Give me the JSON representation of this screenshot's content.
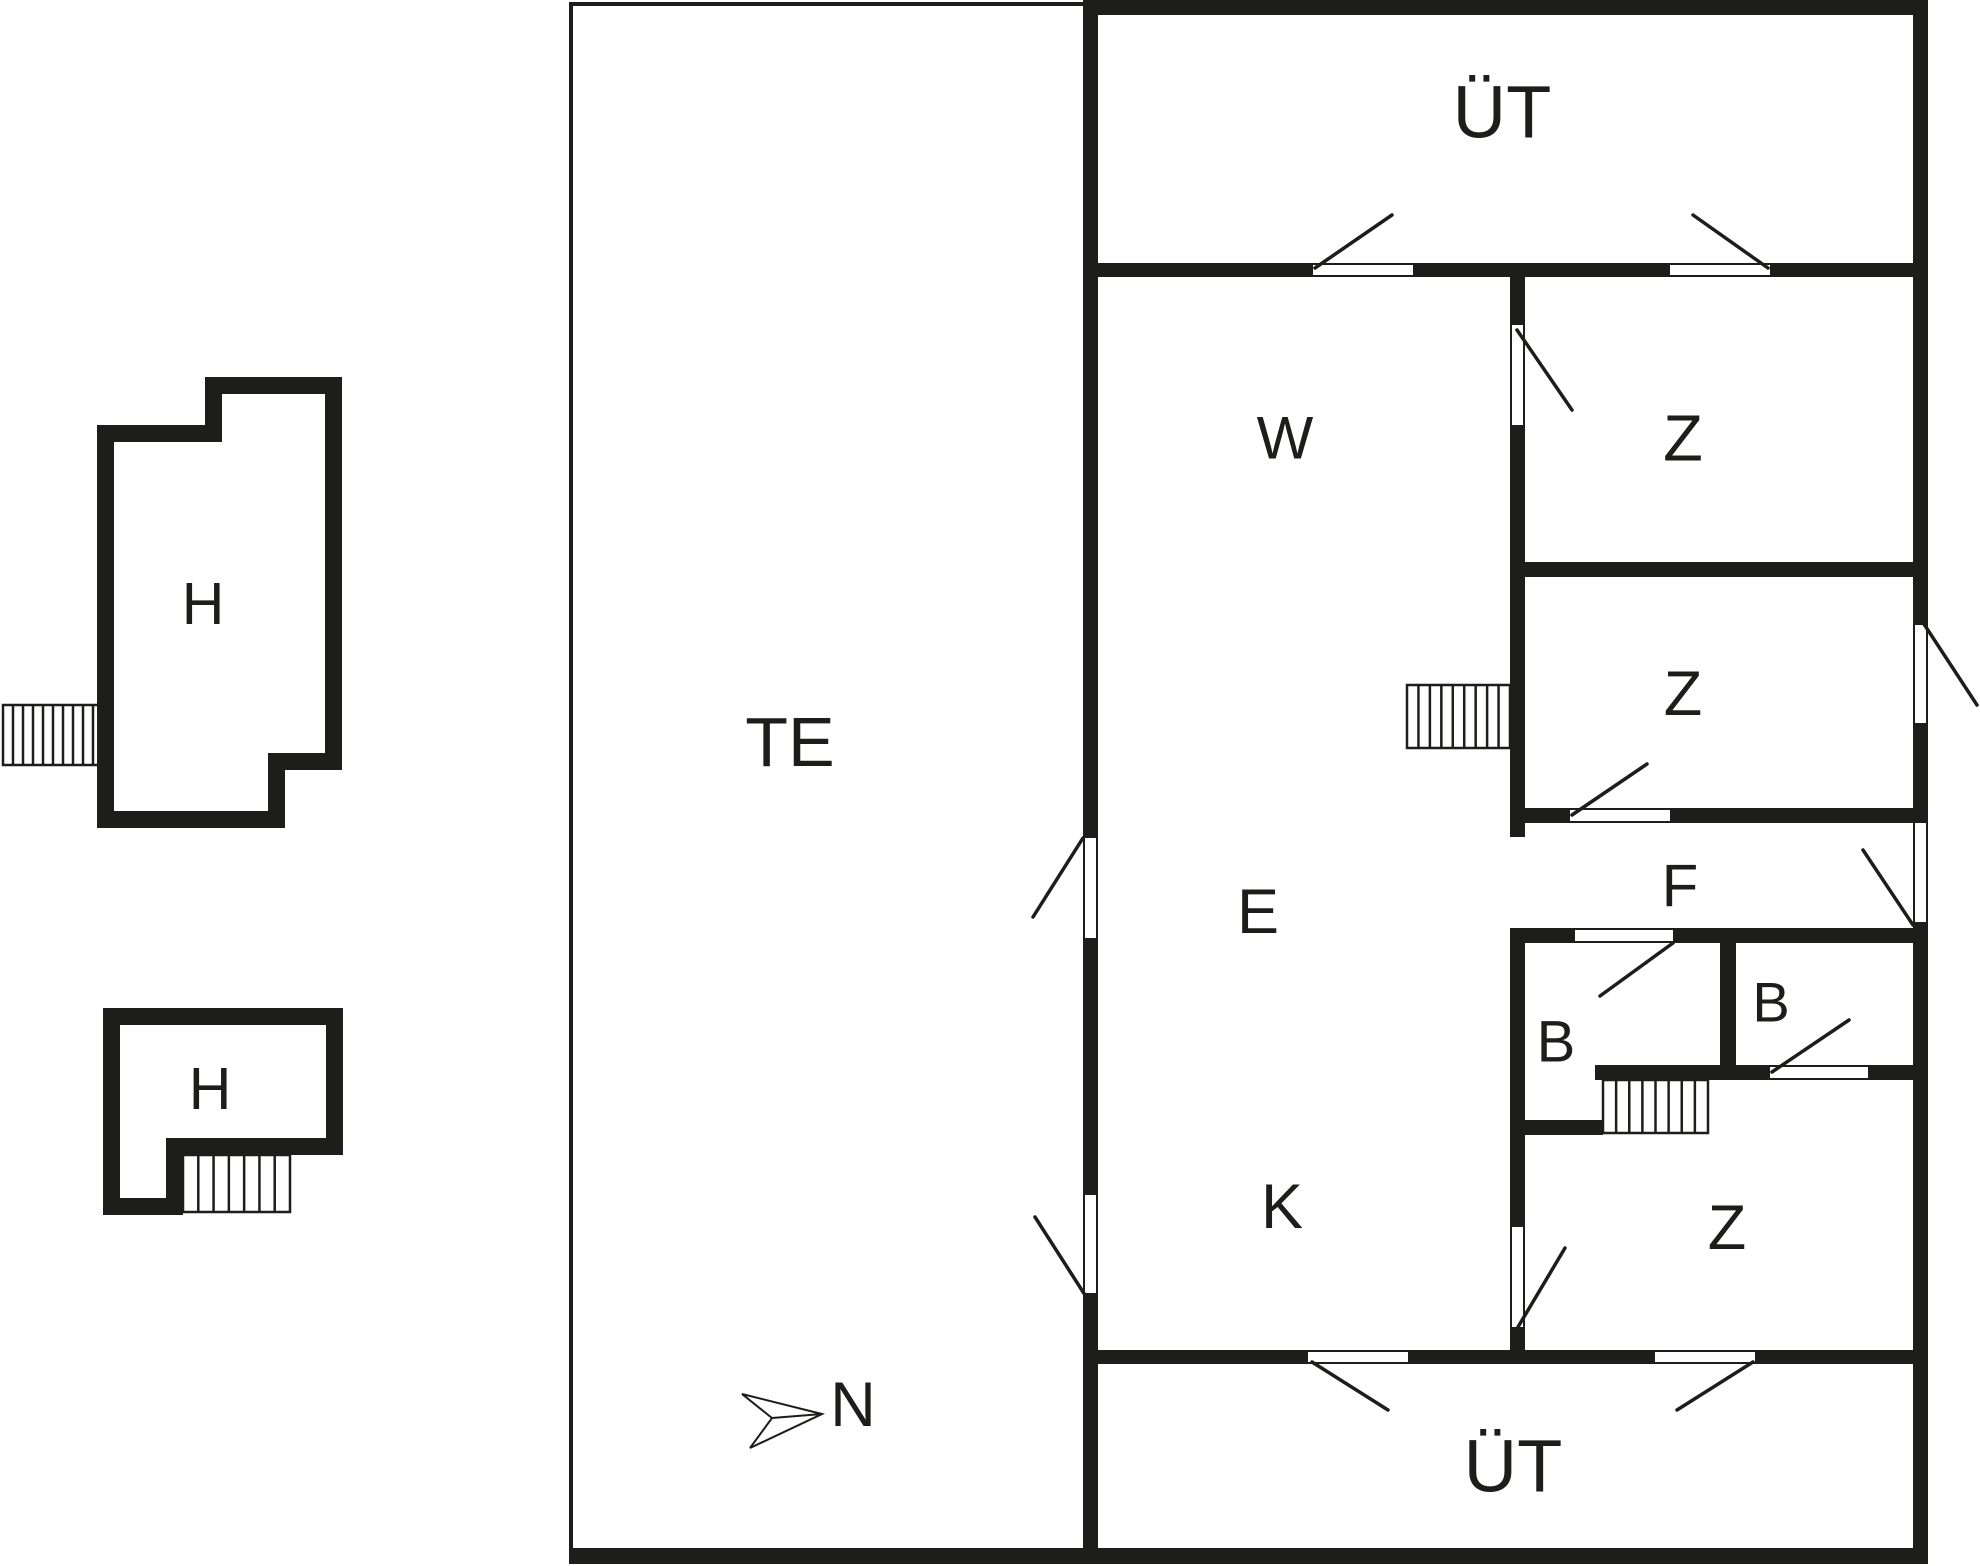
{
  "plan": {
    "ink": "#1d1d1b",
    "bg": "#ffffff",
    "walls": [
      {
        "name": "building-wall-left",
        "x": 1083,
        "y": 0,
        "w": 15,
        "h": 1563
      },
      {
        "name": "building-wall-top",
        "x": 1083,
        "y": 0,
        "w": 845,
        "h": 15
      },
      {
        "name": "building-wall-right",
        "x": 1913,
        "y": 0,
        "w": 15,
        "h": 1563
      },
      {
        "name": "building-wall-bottom",
        "x": 569,
        "y": 1548,
        "w": 1359,
        "h": 16
      },
      {
        "name": "wall-ut-top-bottom",
        "x": 1098,
        "y": 263,
        "w": 830,
        "h": 14
      },
      {
        "name": "wall-main-divider",
        "x": 1510,
        "y": 277,
        "w": 15,
        "h": 1087
      },
      {
        "name": "wall-z1-z2",
        "x": 1510,
        "y": 562,
        "w": 418,
        "h": 15
      },
      {
        "name": "wall-z2-bottom",
        "x": 1510,
        "y": 808,
        "w": 418,
        "h": 15
      },
      {
        "name": "wall-b-top",
        "x": 1510,
        "y": 928,
        "w": 418,
        "h": 15
      },
      {
        "name": "wall-b-divider",
        "x": 1720,
        "y": 943,
        "w": 16,
        "h": 122
      },
      {
        "name": "wall-b-bottom",
        "x": 1595,
        "y": 1065,
        "w": 318,
        "h": 15
      },
      {
        "name": "wall-b-left-bottom",
        "x": 1510,
        "y": 1120,
        "w": 93,
        "h": 15
      },
      {
        "name": "wall-ut-bottom-top",
        "x": 1098,
        "y": 1350,
        "w": 830,
        "h": 14
      }
    ],
    "thin": [
      {
        "name": "terrace-edge-top",
        "x": 569,
        "y": 2,
        "w": 514,
        "h": 4
      },
      {
        "name": "terrace-edge-left",
        "x": 569,
        "y": 2,
        "w": 4,
        "h": 1554
      }
    ],
    "openings": [
      {
        "name": "door-opening-w-to-terrace",
        "x": 1083,
        "y": 838,
        "w": 15,
        "h": 100,
        "dir": "v"
      },
      {
        "name": "door-opening-k-to-terrace",
        "x": 1083,
        "y": 1195,
        "w": 15,
        "h": 98,
        "dir": "v"
      },
      {
        "name": "door-opening-z2-exterior",
        "x": 1913,
        "y": 625,
        "w": 15,
        "h": 98,
        "dir": "v"
      },
      {
        "name": "door-opening-f-exterior",
        "x": 1913,
        "y": 823,
        "w": 15,
        "h": 99,
        "dir": "v"
      },
      {
        "name": "door-opening-ut-top-left",
        "x": 1313,
        "y": 263,
        "w": 100,
        "h": 14,
        "dir": "h"
      },
      {
        "name": "door-opening-ut-top-right",
        "x": 1670,
        "y": 263,
        "w": 100,
        "h": 14,
        "dir": "h"
      },
      {
        "name": "door-opening-w-to-z1",
        "x": 1510,
        "y": 325,
        "w": 15,
        "h": 100,
        "dir": "v"
      },
      {
        "name": "passage-e-to-f",
        "x": 1510,
        "y": 837,
        "w": 15,
        "h": 91,
        "dir": "v",
        "frame": false
      },
      {
        "name": "door-opening-k-to-z3",
        "x": 1510,
        "y": 1227,
        "w": 15,
        "h": 100,
        "dir": "v"
      },
      {
        "name": "door-opening-f-to-z2",
        "x": 1570,
        "y": 808,
        "w": 100,
        "h": 15,
        "dir": "h"
      },
      {
        "name": "door-opening-f-to-b-left",
        "x": 1575,
        "y": 928,
        "w": 98,
        "h": 15,
        "dir": "h"
      },
      {
        "name": "door-opening-z3-to-b-right",
        "x": 1770,
        "y": 1065,
        "w": 98,
        "h": 15,
        "dir": "h"
      },
      {
        "name": "door-opening-ut-bottom-left",
        "x": 1308,
        "y": 1350,
        "w": 100,
        "h": 14,
        "dir": "h"
      },
      {
        "name": "door-opening-ut-bottom-right",
        "x": 1655,
        "y": 1350,
        "w": 100,
        "h": 14,
        "dir": "h"
      }
    ],
    "swings": [
      {
        "name": "door-swing-w-to-terrace",
        "x1": 1083,
        "y1": 838,
        "x2": 1033,
        "y2": 917
      },
      {
        "name": "door-swing-k-to-terrace",
        "x1": 1085,
        "y1": 1295,
        "x2": 1035,
        "y2": 1217
      },
      {
        "name": "door-swing-z2-exterior",
        "x1": 1920,
        "y1": 618,
        "x2": 1977,
        "y2": 705
      },
      {
        "name": "door-swing-f-exterior",
        "x1": 1913,
        "y1": 925,
        "x2": 1863,
        "y2": 850
      },
      {
        "name": "door-swing-ut-top-left",
        "x1": 1315,
        "y1": 268,
        "x2": 1392,
        "y2": 215
      },
      {
        "name": "door-swing-ut-top-right",
        "x1": 1768,
        "y1": 268,
        "x2": 1693,
        "y2": 215
      },
      {
        "name": "door-swing-w-to-z1",
        "x1": 1517,
        "y1": 330,
        "x2": 1572,
        "y2": 410
      },
      {
        "name": "door-swing-k-to-z3",
        "x1": 1518,
        "y1": 1327,
        "x2": 1565,
        "y2": 1248
      },
      {
        "name": "door-swing-f-to-z2",
        "x1": 1572,
        "y1": 815,
        "x2": 1647,
        "y2": 764
      },
      {
        "name": "door-swing-f-to-b-left",
        "x1": 1673,
        "y1": 943,
        "x2": 1600,
        "y2": 996
      },
      {
        "name": "door-swing-z3-to-b-right",
        "x1": 1772,
        "y1": 1072,
        "x2": 1849,
        "y2": 1020
      },
      {
        "name": "door-swing-ut-bottom-left",
        "x1": 1312,
        "y1": 1362,
        "x2": 1388,
        "y2": 1410
      },
      {
        "name": "door-swing-ut-bottom-right",
        "x1": 1753,
        "y1": 1362,
        "x2": 1677,
        "y2": 1410
      }
    ],
    "stairs": [
      {
        "name": "stairs-outbuilding-1",
        "x": 3,
        "y": 705,
        "w": 100,
        "h": 60,
        "steps": 10
      },
      {
        "name": "stairs-z2-entry",
        "x": 1407,
        "y": 685,
        "w": 103,
        "h": 63,
        "steps": 9
      },
      {
        "name": "stairs-interior",
        "x": 1603,
        "y": 1080,
        "w": 105,
        "h": 53,
        "steps": 8
      },
      {
        "name": "stairs-outbuilding-2",
        "x": 183,
        "y": 1155,
        "w": 107,
        "h": 57,
        "steps": 7
      }
    ],
    "buildings": [
      {
        "name": "outbuilding-h1",
        "outer": [
          [
            97,
            425
          ],
          [
            205,
            425
          ],
          [
            205,
            377
          ],
          [
            342,
            377
          ],
          [
            342,
            770
          ],
          [
            285,
            770
          ],
          [
            285,
            828
          ],
          [
            97,
            828
          ]
        ],
        "inner": [
          [
            114,
            442
          ],
          [
            222,
            442
          ],
          [
            222,
            394
          ],
          [
            325,
            394
          ],
          [
            325,
            753
          ],
          [
            268,
            753
          ],
          [
            268,
            811
          ],
          [
            114,
            811
          ]
        ]
      },
      {
        "name": "outbuilding-h2",
        "outer": [
          [
            103,
            1008
          ],
          [
            343,
            1008
          ],
          [
            343,
            1155
          ],
          [
            183,
            1155
          ],
          [
            183,
            1215
          ],
          [
            103,
            1215
          ]
        ],
        "inner": [
          [
            120,
            1025
          ],
          [
            326,
            1025
          ],
          [
            326,
            1138
          ],
          [
            166,
            1138
          ],
          [
            166,
            1198
          ],
          [
            120,
            1198
          ]
        ]
      }
    ],
    "compass": {
      "label": "N",
      "x": 853,
      "y": 1405,
      "size": 63,
      "arrow": [
        [
          822,
          1414
        ],
        [
          742,
          1394
        ],
        [
          772,
          1418
        ],
        [
          750,
          1448
        ]
      ]
    },
    "labels": [
      {
        "name": "room-label-terrace",
        "text": "TE",
        "x": 790,
        "y": 742,
        "size": 70
      },
      {
        "name": "room-label-ut-top",
        "text": "ÜT",
        "x": 1502,
        "y": 112,
        "size": 74
      },
      {
        "name": "room-label-w",
        "text": "W",
        "x": 1285,
        "y": 438,
        "size": 60
      },
      {
        "name": "room-label-z-upper",
        "text": "Z",
        "x": 1683,
        "y": 438,
        "size": 65
      },
      {
        "name": "room-label-z-middle",
        "text": "Z",
        "x": 1683,
        "y": 694,
        "size": 63
      },
      {
        "name": "room-label-e",
        "text": "E",
        "x": 1258,
        "y": 912,
        "size": 63
      },
      {
        "name": "room-label-f",
        "text": "F",
        "x": 1680,
        "y": 886,
        "size": 60
      },
      {
        "name": "room-label-b-left",
        "text": "B",
        "x": 1556,
        "y": 1042,
        "size": 58
      },
      {
        "name": "room-label-b-right",
        "text": "B",
        "x": 1771,
        "y": 1002,
        "size": 56
      },
      {
        "name": "room-label-k",
        "text": "K",
        "x": 1282,
        "y": 1207,
        "size": 63
      },
      {
        "name": "room-label-z-bottom",
        "text": "Z",
        "x": 1727,
        "y": 1228,
        "size": 63
      },
      {
        "name": "room-label-ut-bottom",
        "text": "ÜT",
        "x": 1513,
        "y": 1466,
        "size": 74
      },
      {
        "name": "room-label-h1",
        "text": "H",
        "x": 203,
        "y": 604,
        "size": 59
      },
      {
        "name": "room-label-h2",
        "text": "H",
        "x": 210,
        "y": 1089,
        "size": 59
      }
    ]
  }
}
